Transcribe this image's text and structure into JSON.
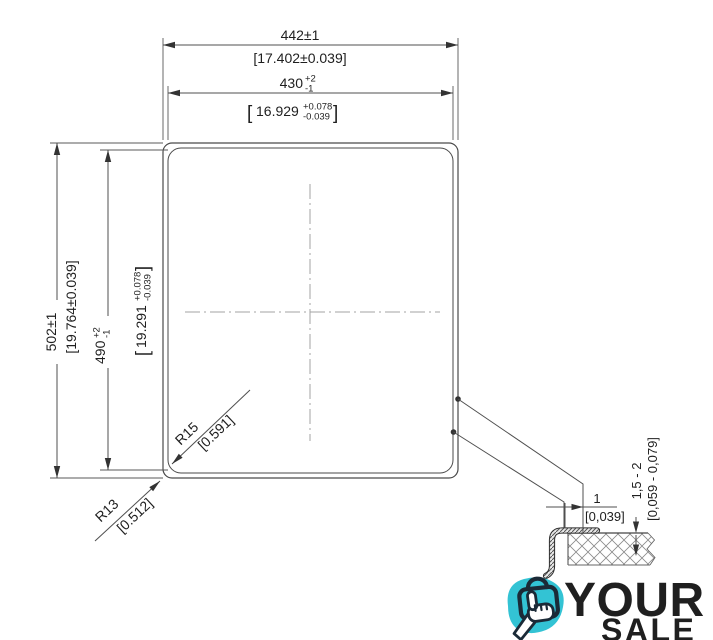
{
  "drawing": {
    "width_outer": {
      "value": "442±1",
      "alt": "[17.402±0.039]"
    },
    "width_inner": {
      "value": "430",
      "tol_plus": "+2",
      "tol_minus": "-1",
      "alt_open": "[",
      "alt_value": "16.929",
      "alt_tol_plus": "+0.078",
      "alt_tol_minus": "-0.039",
      "alt_close": "]"
    },
    "height_outer": {
      "value": "502±1",
      "alt": "[19.764±0.039]"
    },
    "height_inner": {
      "value": "490",
      "tol_plus": "+2",
      "tol_minus": "-1",
      "alt_open": "[",
      "alt_value": "19.291",
      "alt_tol_plus": "+0.078",
      "alt_tol_minus": "-0.039",
      "alt_close": "]"
    },
    "radius_inner": {
      "value": "R15",
      "alt": "[0.591]"
    },
    "radius_outer": {
      "value": "R13",
      "alt": "[0.512]"
    },
    "section": {
      "gap": {
        "value": "1",
        "alt": "[0,039]"
      },
      "depth": {
        "value": "1,5 - 2",
        "alt": "[0,059 - 0,079]"
      }
    }
  },
  "logo": {
    "word_top": "YOUR",
    "word_bottom": "SALE"
  },
  "colors": {
    "navy": "#1b2a37",
    "cyan": "#33c3d4",
    "line": "#4f4f4f",
    "text": "#1f1f1f"
  }
}
